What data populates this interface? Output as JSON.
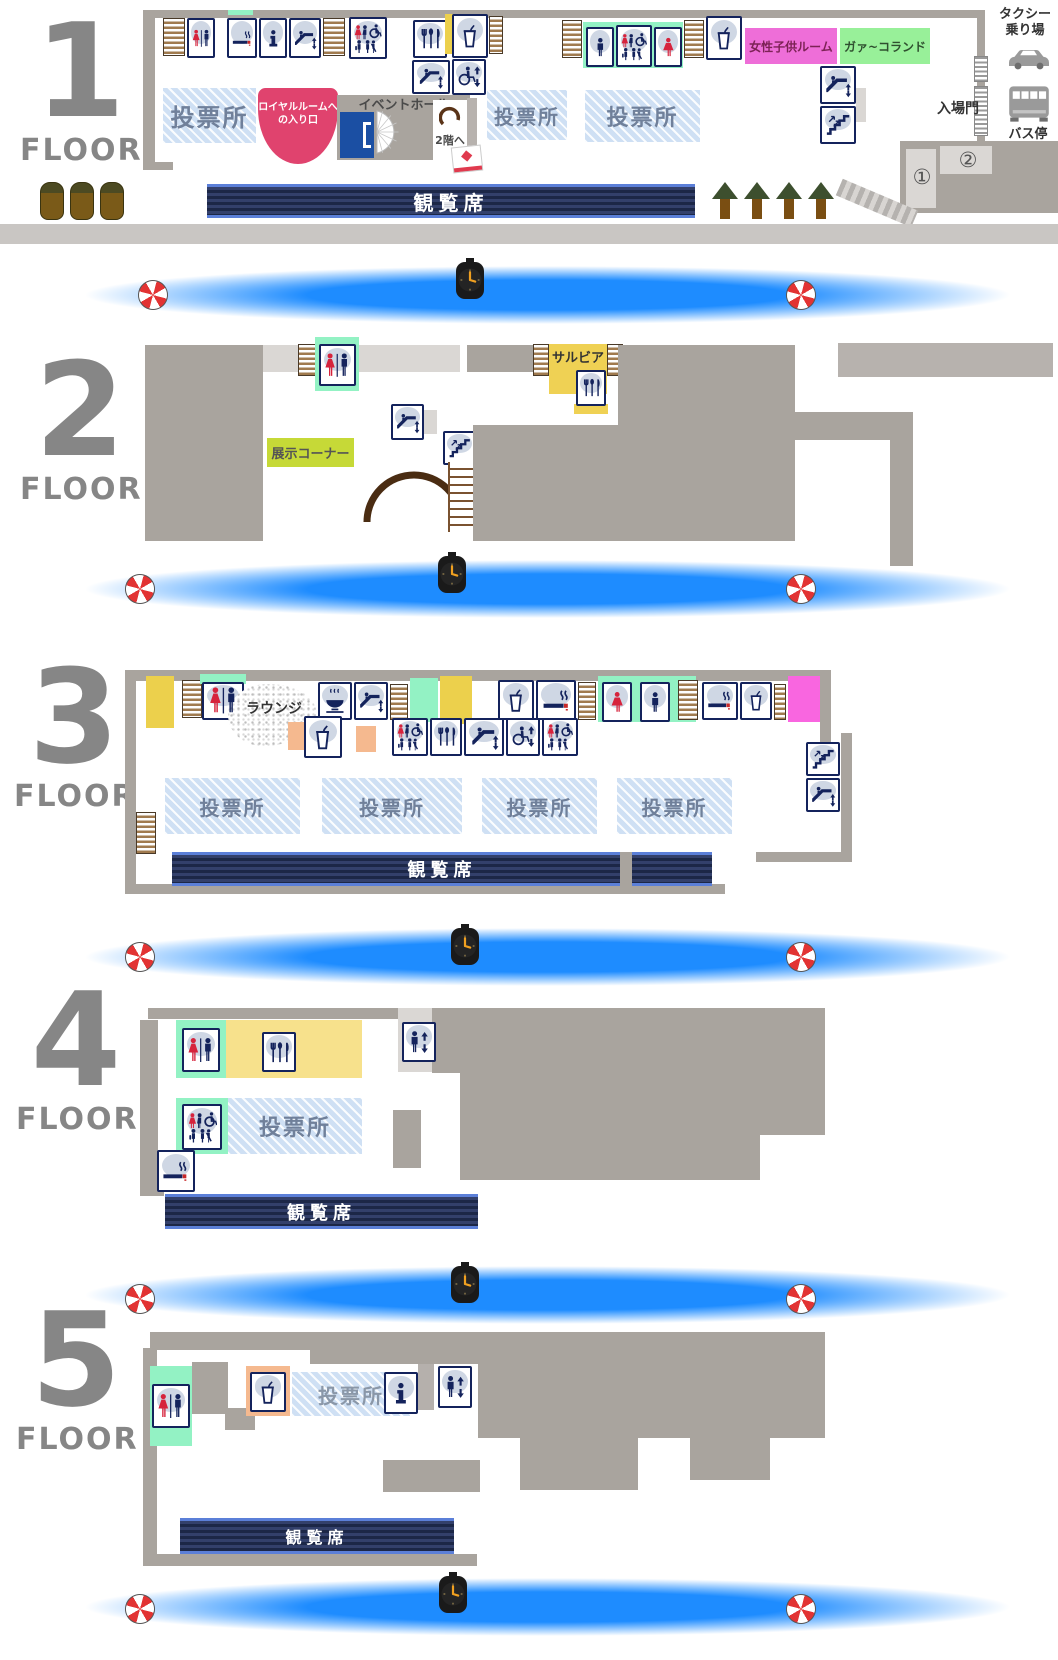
{
  "floors": [
    "1",
    "2",
    "3",
    "4",
    "5"
  ],
  "labels": {
    "floor_word": "FLOOR",
    "betting": "投票所",
    "seating": "観覧席",
    "event_hall": "イベントホール",
    "royal_room": "ロイヤルルームへの入り口",
    "to_2f": "2階へ",
    "women_children": "女性子供ルーム",
    "gaako": "ガァ~コランド",
    "taxi": "タクシー乗り場",
    "gate": "入場門",
    "bus": "バス停",
    "no1": "①",
    "no2": "②",
    "salvia": "サルビア",
    "exhibition": "展示コーナー",
    "lounge": "ラウンジ"
  },
  "icons": {
    "restroom-icon": "🚻",
    "mens-restroom-icon": "🚹",
    "womens-restroom-icon": "🚺",
    "accessible-restroom-icon": "♿",
    "smoking-icon": "🚬",
    "information-icon": "ℹ",
    "escalator-icon": "⤴",
    "stairs-icon": "🪜",
    "restaurant-icon": "🍴",
    "drink-icon": "🥤",
    "hot-food-icon": "🍜",
    "elevator-icon": "↕",
    "wheelchair-elevator-icon": "♿↕",
    "clock-icon": "🕒",
    "turn-mark-icon": "◉",
    "taxi-icon": "🚕",
    "bus-icon": "🚌",
    "tree-icon": "🌲"
  },
  "colors": {
    "water": "#1e8cff",
    "turn_mark_red": "#e23333",
    "betting_area": "#cfe0f4",
    "seating_navy": "#1c2747",
    "wall_gray": "#a9a49e",
    "mint_green": "#93f2c4",
    "pink_room": "#ee6ed8",
    "green_land": "#98f099",
    "yellow_zone": "#ecd04c",
    "yellow_pale": "#f7e18c",
    "yellow_green": "#c6d937",
    "royal_pink": "#e0436e",
    "event_blue": "#1b4fa3",
    "magenta_zone": "#f966e0",
    "peach": "#f5b98f",
    "icon_navy": "#14235c",
    "icon_red": "#d6233c"
  }
}
